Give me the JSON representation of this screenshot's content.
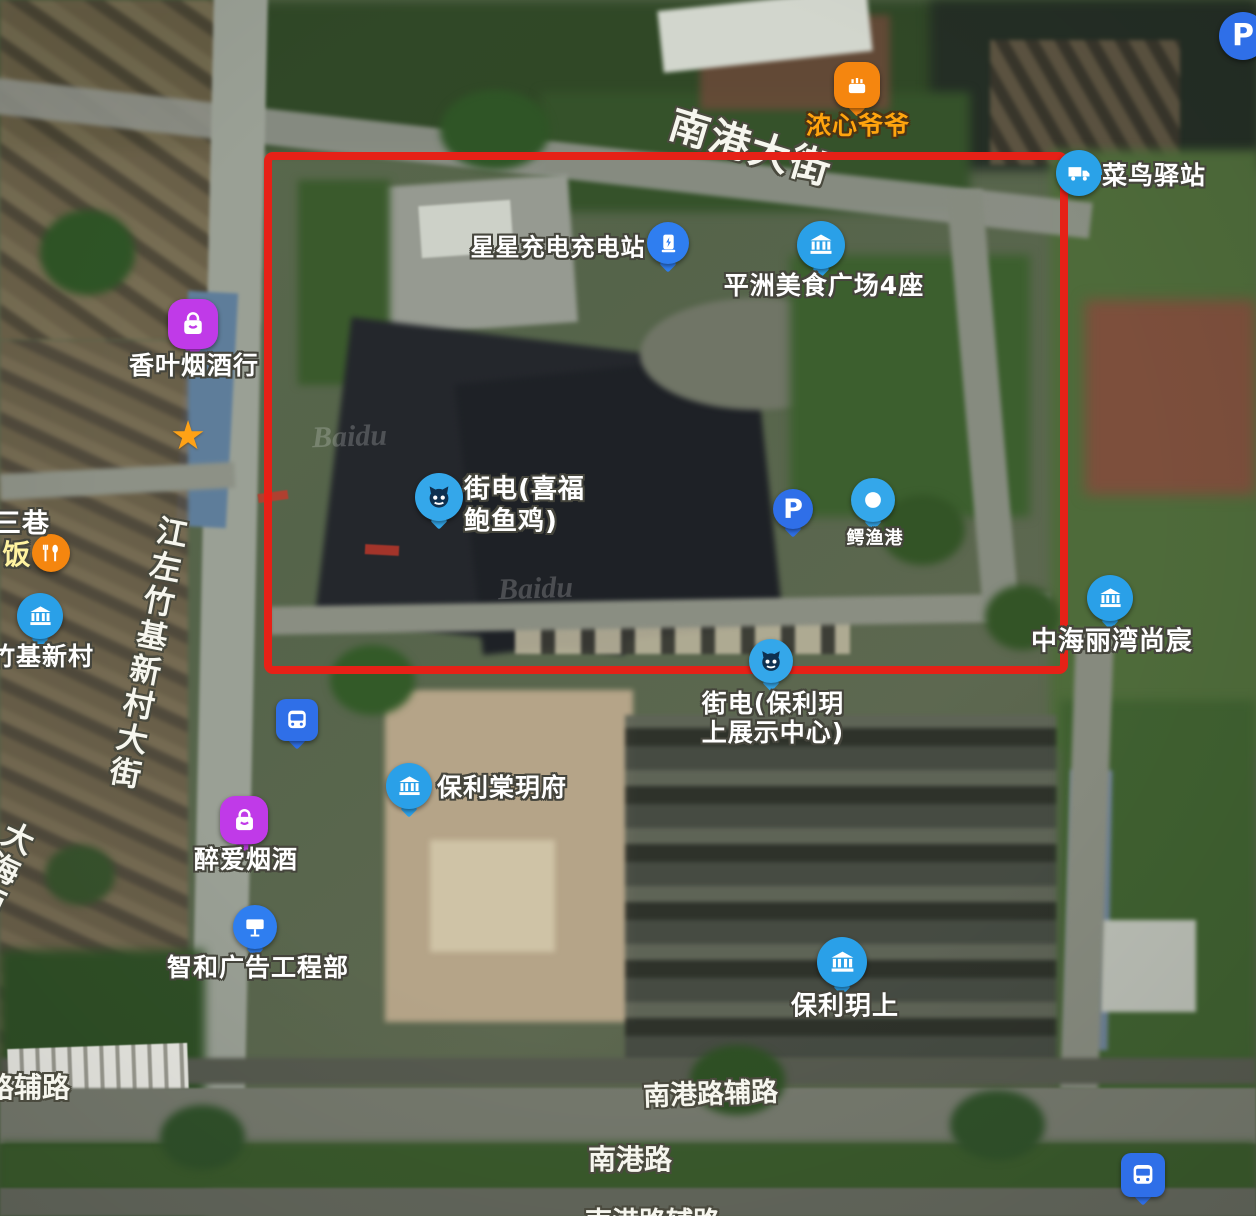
{
  "map": {
    "watermark": "Baidu",
    "star_glyph": "★",
    "parking_letter": "P",
    "annotation": {
      "shape": "rectangle",
      "color": "#e62117"
    }
  },
  "roads": {
    "nangang_dajie": "南港大街",
    "jiangzuo_zhuji_dajie": "江左竹基新村大街",
    "dahaixi": "大海西",
    "lu_fu_lu": "路辅路",
    "nangang_lu_fulu": "南港路辅路",
    "nangang_lu": "南港路",
    "nangang_lu_fulu_bottom": "南港路辅路"
  },
  "pois": [
    {
      "label": "浓心爷爷",
      "icon": "cake-icon",
      "color": "#f5860f",
      "text_color": "#ffa40e"
    },
    {
      "label": "菜鸟驿站",
      "icon": "truck-icon",
      "color": "#2aa2e8"
    },
    {
      "label": "星星充电充电站",
      "icon": "ev-charger-icon",
      "color": "#2f7ef0"
    },
    {
      "label": "平洲美食广场4座",
      "icon": "building-icon",
      "color": "#2aa0e8"
    },
    {
      "label": "香叶烟酒行",
      "icon": "shopping-bag-icon",
      "color": "#c03ae8"
    },
    {
      "label_line1": "街电(喜福",
      "label_line2": "鲍鱼鸡)",
      "icon": "cat-icon",
      "color": "#34a7ea"
    },
    {
      "label": "鳄渔港",
      "icon": "dot-icon",
      "color": "#34a7ea"
    },
    {
      "label": "中海丽湾尚宸",
      "icon": "building-icon",
      "color": "#2aa0e8"
    },
    {
      "label_line1": "街电(保利玥",
      "label_line2": "上展示中心)",
      "icon": "cat-icon",
      "color": "#34a7ea"
    },
    {
      "label": "保利棠玥府",
      "icon": "building-icon",
      "color": "#2aa0e8"
    },
    {
      "label": "醉爱烟酒",
      "icon": "shopping-bag-icon",
      "color": "#c03ae8"
    },
    {
      "label": "智和广告工程部",
      "icon": "billboard-icon",
      "color": "#2f7ef0"
    },
    {
      "label": "保利玥上",
      "icon": "building-icon",
      "color": "#2aa0e8"
    },
    {
      "label": "竹基新村",
      "icon": "building-icon",
      "color": "#2aa0e8"
    },
    {
      "label": "饭",
      "icon": "restaurant-icon",
      "color": "#f5860f"
    },
    {
      "label": "三巷"
    }
  ]
}
